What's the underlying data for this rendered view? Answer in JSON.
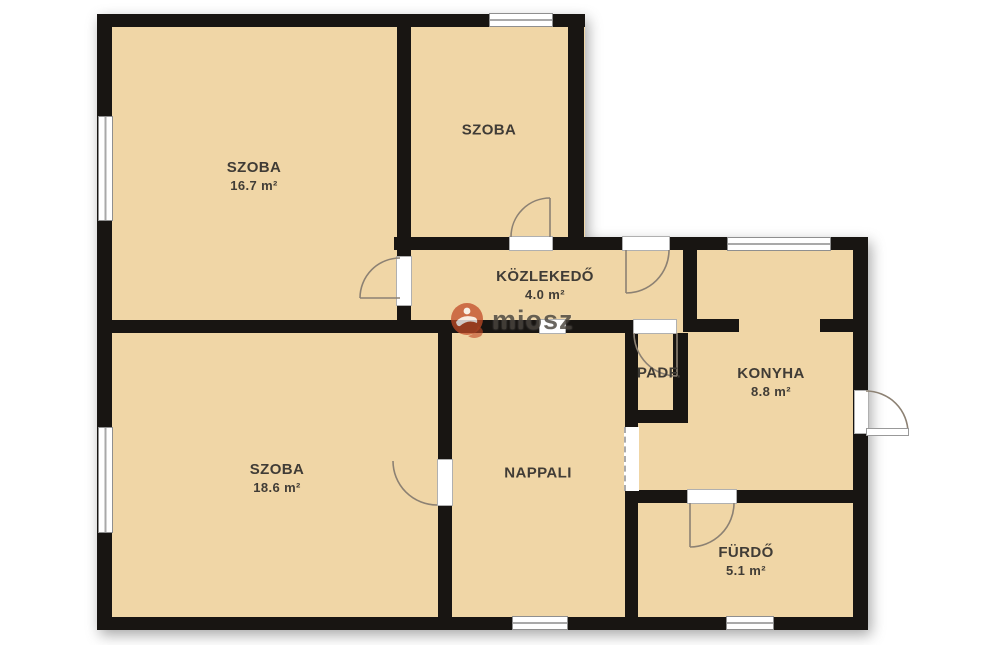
{
  "plan_title": "floor-plan",
  "watermark": {
    "text": "miosz",
    "logo_color": "#c14a26"
  },
  "palette": {
    "room_fill": "#f0d6a6",
    "wall": "#181512",
    "label_text": "#403c36",
    "window_frame": "#8f8f8f",
    "door_arc": "#8c8173",
    "watermark_orange": "#c14a26"
  },
  "rooms": [
    {
      "id": "szoba-1",
      "name": "SZOBA",
      "area": "16.7 m²"
    },
    {
      "id": "szoba-2",
      "name": "SZOBA",
      "area": ""
    },
    {
      "id": "kozlekedo",
      "name": "KÖZLEKEDŐ",
      "area": "4.0 m²"
    },
    {
      "id": "padf",
      "name": "PADF.",
      "area": ""
    },
    {
      "id": "konyha",
      "name": "KONYHA",
      "area": "8.8 m²"
    },
    {
      "id": "nappali",
      "name": "NAPPALI",
      "area": ""
    },
    {
      "id": "szoba-3",
      "name": "SZOBA",
      "area": "18.6 m²"
    },
    {
      "id": "furdo",
      "name": "FÜRDŐ",
      "area": "5.1 m²"
    }
  ]
}
